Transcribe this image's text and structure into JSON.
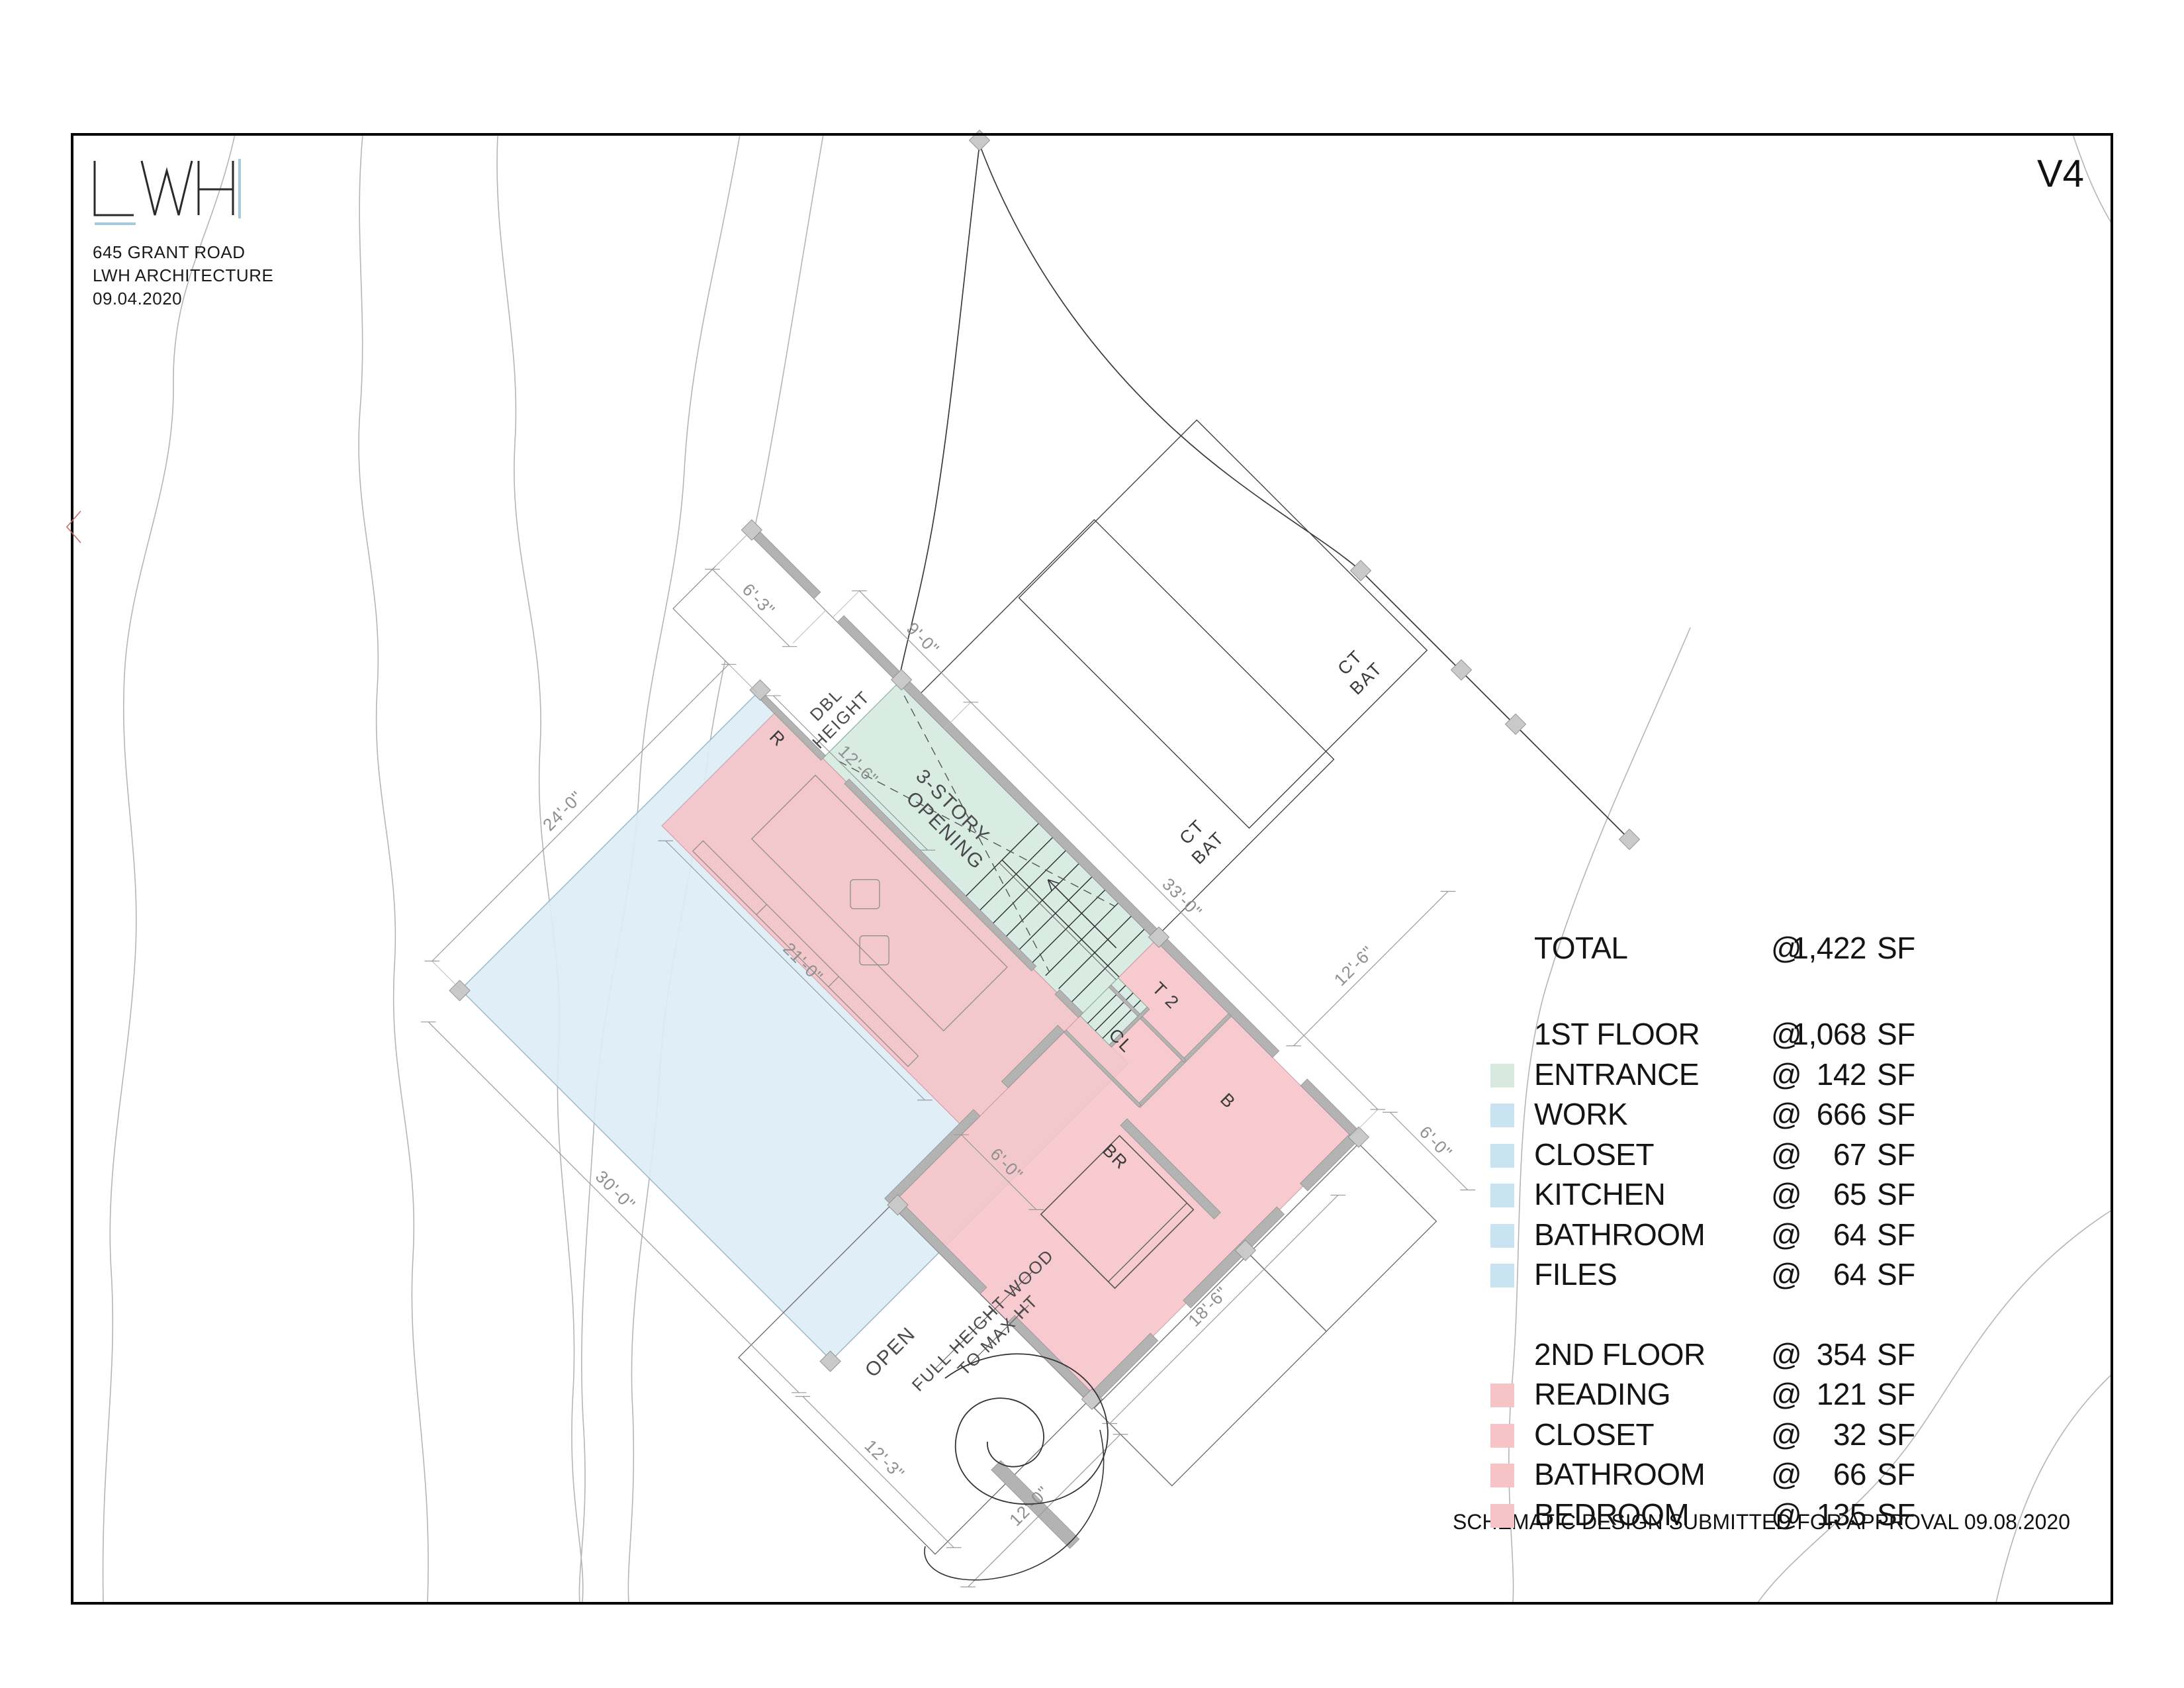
{
  "header": {
    "logo": "LWH",
    "address_line1": "645 GRANT ROAD",
    "address_line2": "LWH ARCHITECTURE",
    "date": "09.04.2020",
    "version": "V4"
  },
  "footer": {
    "approval": "SCHEMATIC DESIGN SUBMITTED FOR APPROVAL 09.08.2020"
  },
  "colors": {
    "entrance_swatch": "#d8eae0",
    "first_floor_swatch": "#c9e3f2",
    "second_floor_swatch": "#f6c3c7",
    "plan_blue": "#dcedf6",
    "plan_green": "#d9ece3",
    "plan_pink": "#f5c3c7"
  },
  "legend": {
    "total": {
      "label": "TOTAL",
      "at": "@",
      "value": "1,422",
      "unit": "SF"
    },
    "floor1": {
      "label": "1ST FLOOR",
      "at": "@",
      "value": "1,068",
      "unit": "SF",
      "rows": [
        {
          "label": "ENTRANCE",
          "at": "@",
          "value": "142",
          "unit": "SF"
        },
        {
          "label": "WORK",
          "at": "@",
          "value": "666",
          "unit": "SF"
        },
        {
          "label": "CLOSET",
          "at": "@",
          "value": "67",
          "unit": "SF"
        },
        {
          "label": "KITCHEN",
          "at": "@",
          "value": "65",
          "unit": "SF"
        },
        {
          "label": "BATHROOM",
          "at": "@",
          "value": "64",
          "unit": "SF"
        },
        {
          "label": "FILES",
          "at": "@",
          "value": "64",
          "unit": "SF"
        }
      ]
    },
    "floor2": {
      "label": "2ND FLOOR",
      "at": "@",
      "value": "354",
      "unit": "SF",
      "rows": [
        {
          "label": "READING",
          "at": "@",
          "value": "121",
          "unit": "SF"
        },
        {
          "label": "CLOSET",
          "at": "@",
          "value": "32",
          "unit": "SF"
        },
        {
          "label": "BATHROOM",
          "at": "@",
          "value": "66",
          "unit": "SF"
        },
        {
          "label": "BEDROOM",
          "at": "@",
          "value": "135",
          "unit": "SF"
        }
      ]
    }
  },
  "plan": {
    "rooms": {
      "reading": "R",
      "toilet2": "T 2",
      "closet": "CL",
      "bath": "B",
      "bedroom": "BR",
      "ctbat1_l1": "CT",
      "ctbat1_l2": "BAT",
      "ctbat2_l1": "CT",
      "ctbat2_l2": "BAT"
    },
    "annotations": {
      "dbl1": "DBL",
      "dbl2": "HEIGHT",
      "opening1": "3-STORY",
      "opening2": "OPENING",
      "open": "OPEN",
      "wood1": "FULL HEIGHT WOOD",
      "wood2": "TO MAX HT"
    },
    "dims": {
      "d24": "24'-0\"",
      "d30": "30'-0\"",
      "d21": "21'-0\"",
      "d12_6": "12'-6\"",
      "d6_3": "6'-3\"",
      "d9": "9'-0\"",
      "d33": "33'-0\"",
      "d12_3": "12'-3\"",
      "d12_0": "12'-0\"",
      "d18_6": "18'-6\"",
      "d6_0a": "6'-0\"",
      "d6_0b": "6'-0\"",
      "d12_6b": "12'-6\""
    }
  }
}
